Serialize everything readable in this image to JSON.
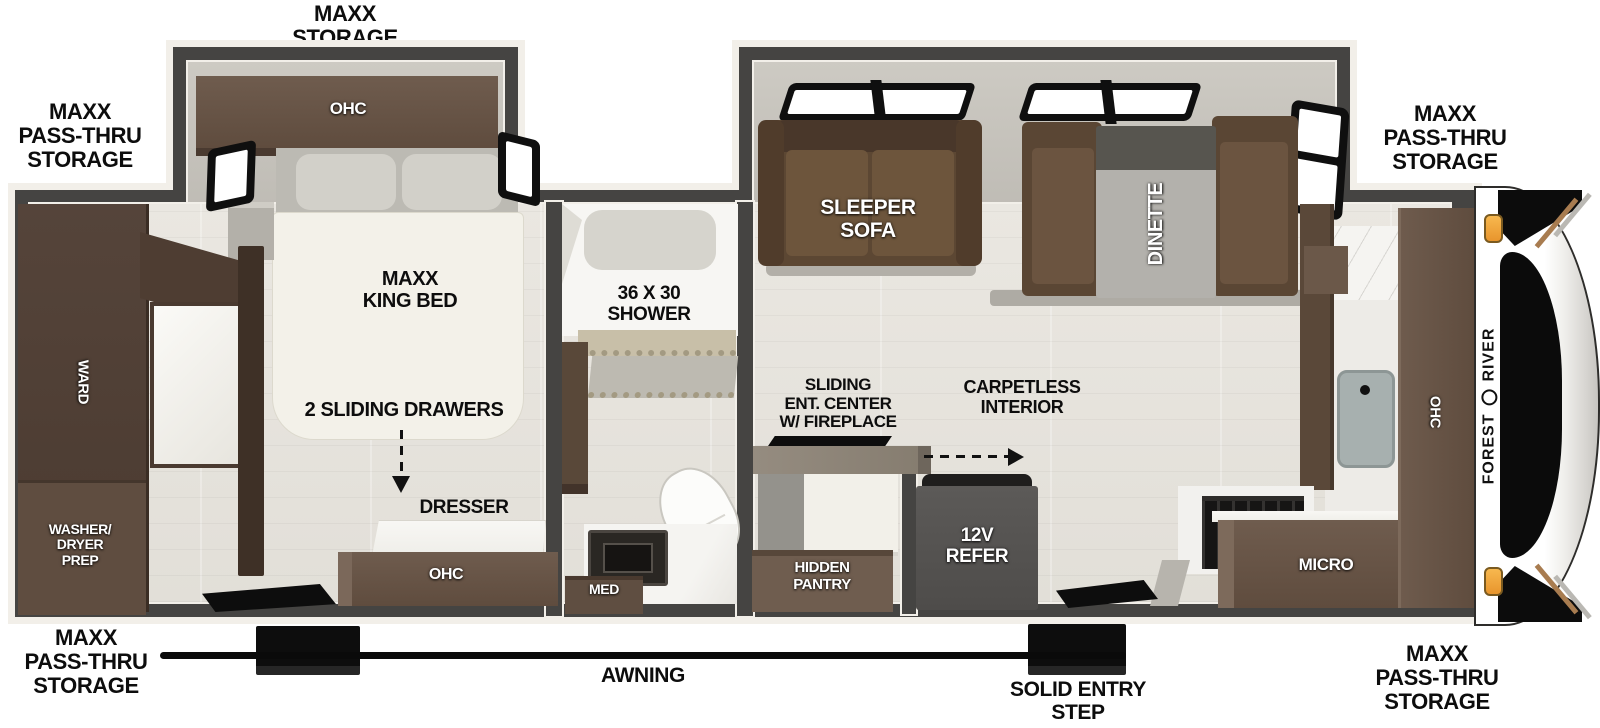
{
  "exterior": {
    "maxx_storage": "MAXX\nSTORAGE",
    "maxx_passthru": "MAXX\nPASS-THRU\nSTORAGE",
    "awning": "AWNING",
    "solid_entry_step": "SOLID ENTRY\nSTEP"
  },
  "brand": {
    "word1": "FOREST",
    "word2": "RIVER"
  },
  "bedroom": {
    "ohc": "OHC",
    "king_bed": "MAXX\nKING BED",
    "sliding_drawers": "2 SLIDING DRAWERS",
    "dresser": "DRESSER",
    "dresser_ohc": "OHC",
    "ward": "WARD",
    "washer_dryer": "WASHER/\nDRYER\nPREP"
  },
  "bathroom": {
    "shower": "36 X 30\nSHOWER",
    "med": "MED"
  },
  "living": {
    "sleeper_sofa": "SLEEPER\nSOFA",
    "dinette": "DINETTE",
    "ent_center": "SLIDING\nENT. CENTER\nW/ FIREPLACE",
    "carpetless": "CARPETLESS\nINTERIOR",
    "hidden_pantry": "HIDDEN\nPANTRY",
    "refer": "12V\nREFER"
  },
  "kitchen": {
    "micro": "MICRO",
    "ohc": "OHC"
  },
  "colors": {
    "wall": "#454442",
    "trim": "#f2efe9",
    "floor": "#e6e3dc",
    "cabinet_brown": "#6a5749",
    "cabinet_dark": "#4a3a2f",
    "sofa_brown": "#5c4733",
    "bed_white": "#f3f1e9",
    "refer_gray": "#565452",
    "marker_amber": "#f2a83c",
    "line_black": "#0d0d0d"
  }
}
